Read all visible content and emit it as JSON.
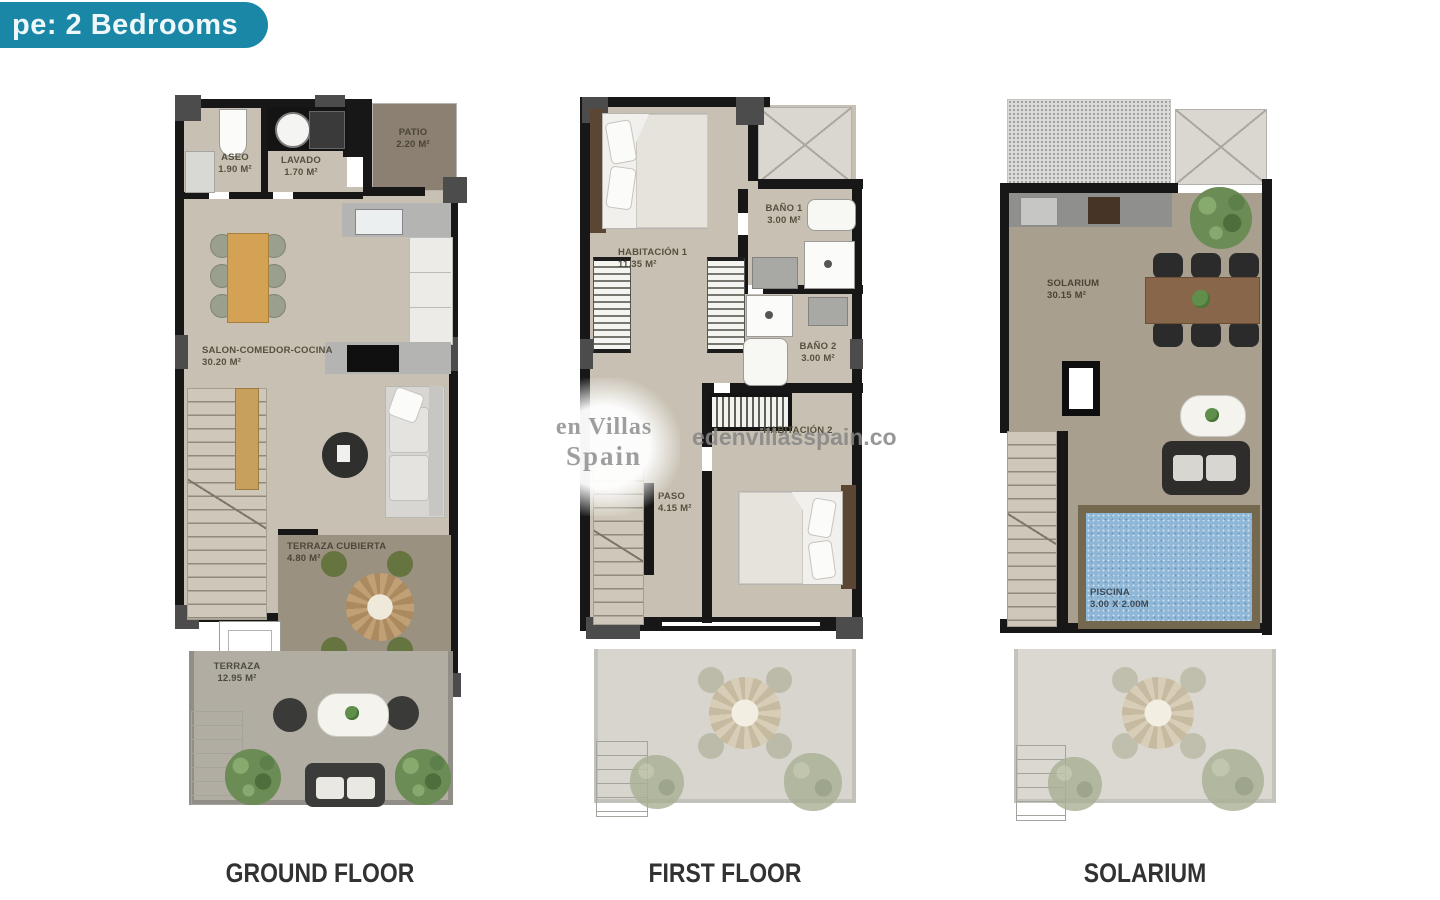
{
  "badge": {
    "label": "pe: 2 Bedrooms"
  },
  "watermark": {
    "line1": "en Villas",
    "line2": "Spain",
    "url": "edenvillasspain.co"
  },
  "floors": [
    {
      "title": "GROUND FLOOR",
      "rooms": {
        "aseo": {
          "name": "ASEO",
          "area": "1.90 m²"
        },
        "lavado": {
          "name": "LAVADO",
          "area": "1.70 m²"
        },
        "patio": {
          "name": "PATIO",
          "area": "2.20 m²"
        },
        "salon": {
          "name": "SALON-COMEDOR-COCINA",
          "area": "30.20 m²"
        },
        "terraza_cubierta": {
          "name": "TERRAZA CUBIERTA",
          "area": "4.80 m²"
        },
        "terraza": {
          "name": "TERRAZA",
          "area": "12.95 m²"
        }
      }
    },
    {
      "title": "FIRST FLOOR",
      "rooms": {
        "habitacion1": {
          "name": "HABITACIÓN 1",
          "area": "11.35 m²"
        },
        "bano1": {
          "name": "BAÑO 1",
          "area": "3.00 m²"
        },
        "bano2": {
          "name": "BAÑO 2",
          "area": "3.00 m²"
        },
        "paso": {
          "name": "PASO",
          "area": "4.15 m²"
        },
        "habitacion2": {
          "name": "HABITACIÓN 2",
          "area": ""
        }
      }
    },
    {
      "title": "SOLARIUM",
      "rooms": {
        "solarium": {
          "name": "SOLARIUM",
          "area": "30.15 m²"
        },
        "piscina": {
          "name": "PISCINA",
          "area": "3.00 x 2.00m"
        }
      }
    }
  ],
  "colors": {
    "accent_teal": "#1a87a6",
    "wall_black": "#171717",
    "floor_beige": "#c8c1b3",
    "patio_brown": "#8b8071",
    "covered_terrace_brown": "#9a9181",
    "terrace_gray": "#b1ada3",
    "solarium_taupe": "#a89f8f",
    "pool_blue": "#8fb7d7",
    "pool_deck_brown": "#74684f",
    "wood_table": "#d3a254"
  }
}
